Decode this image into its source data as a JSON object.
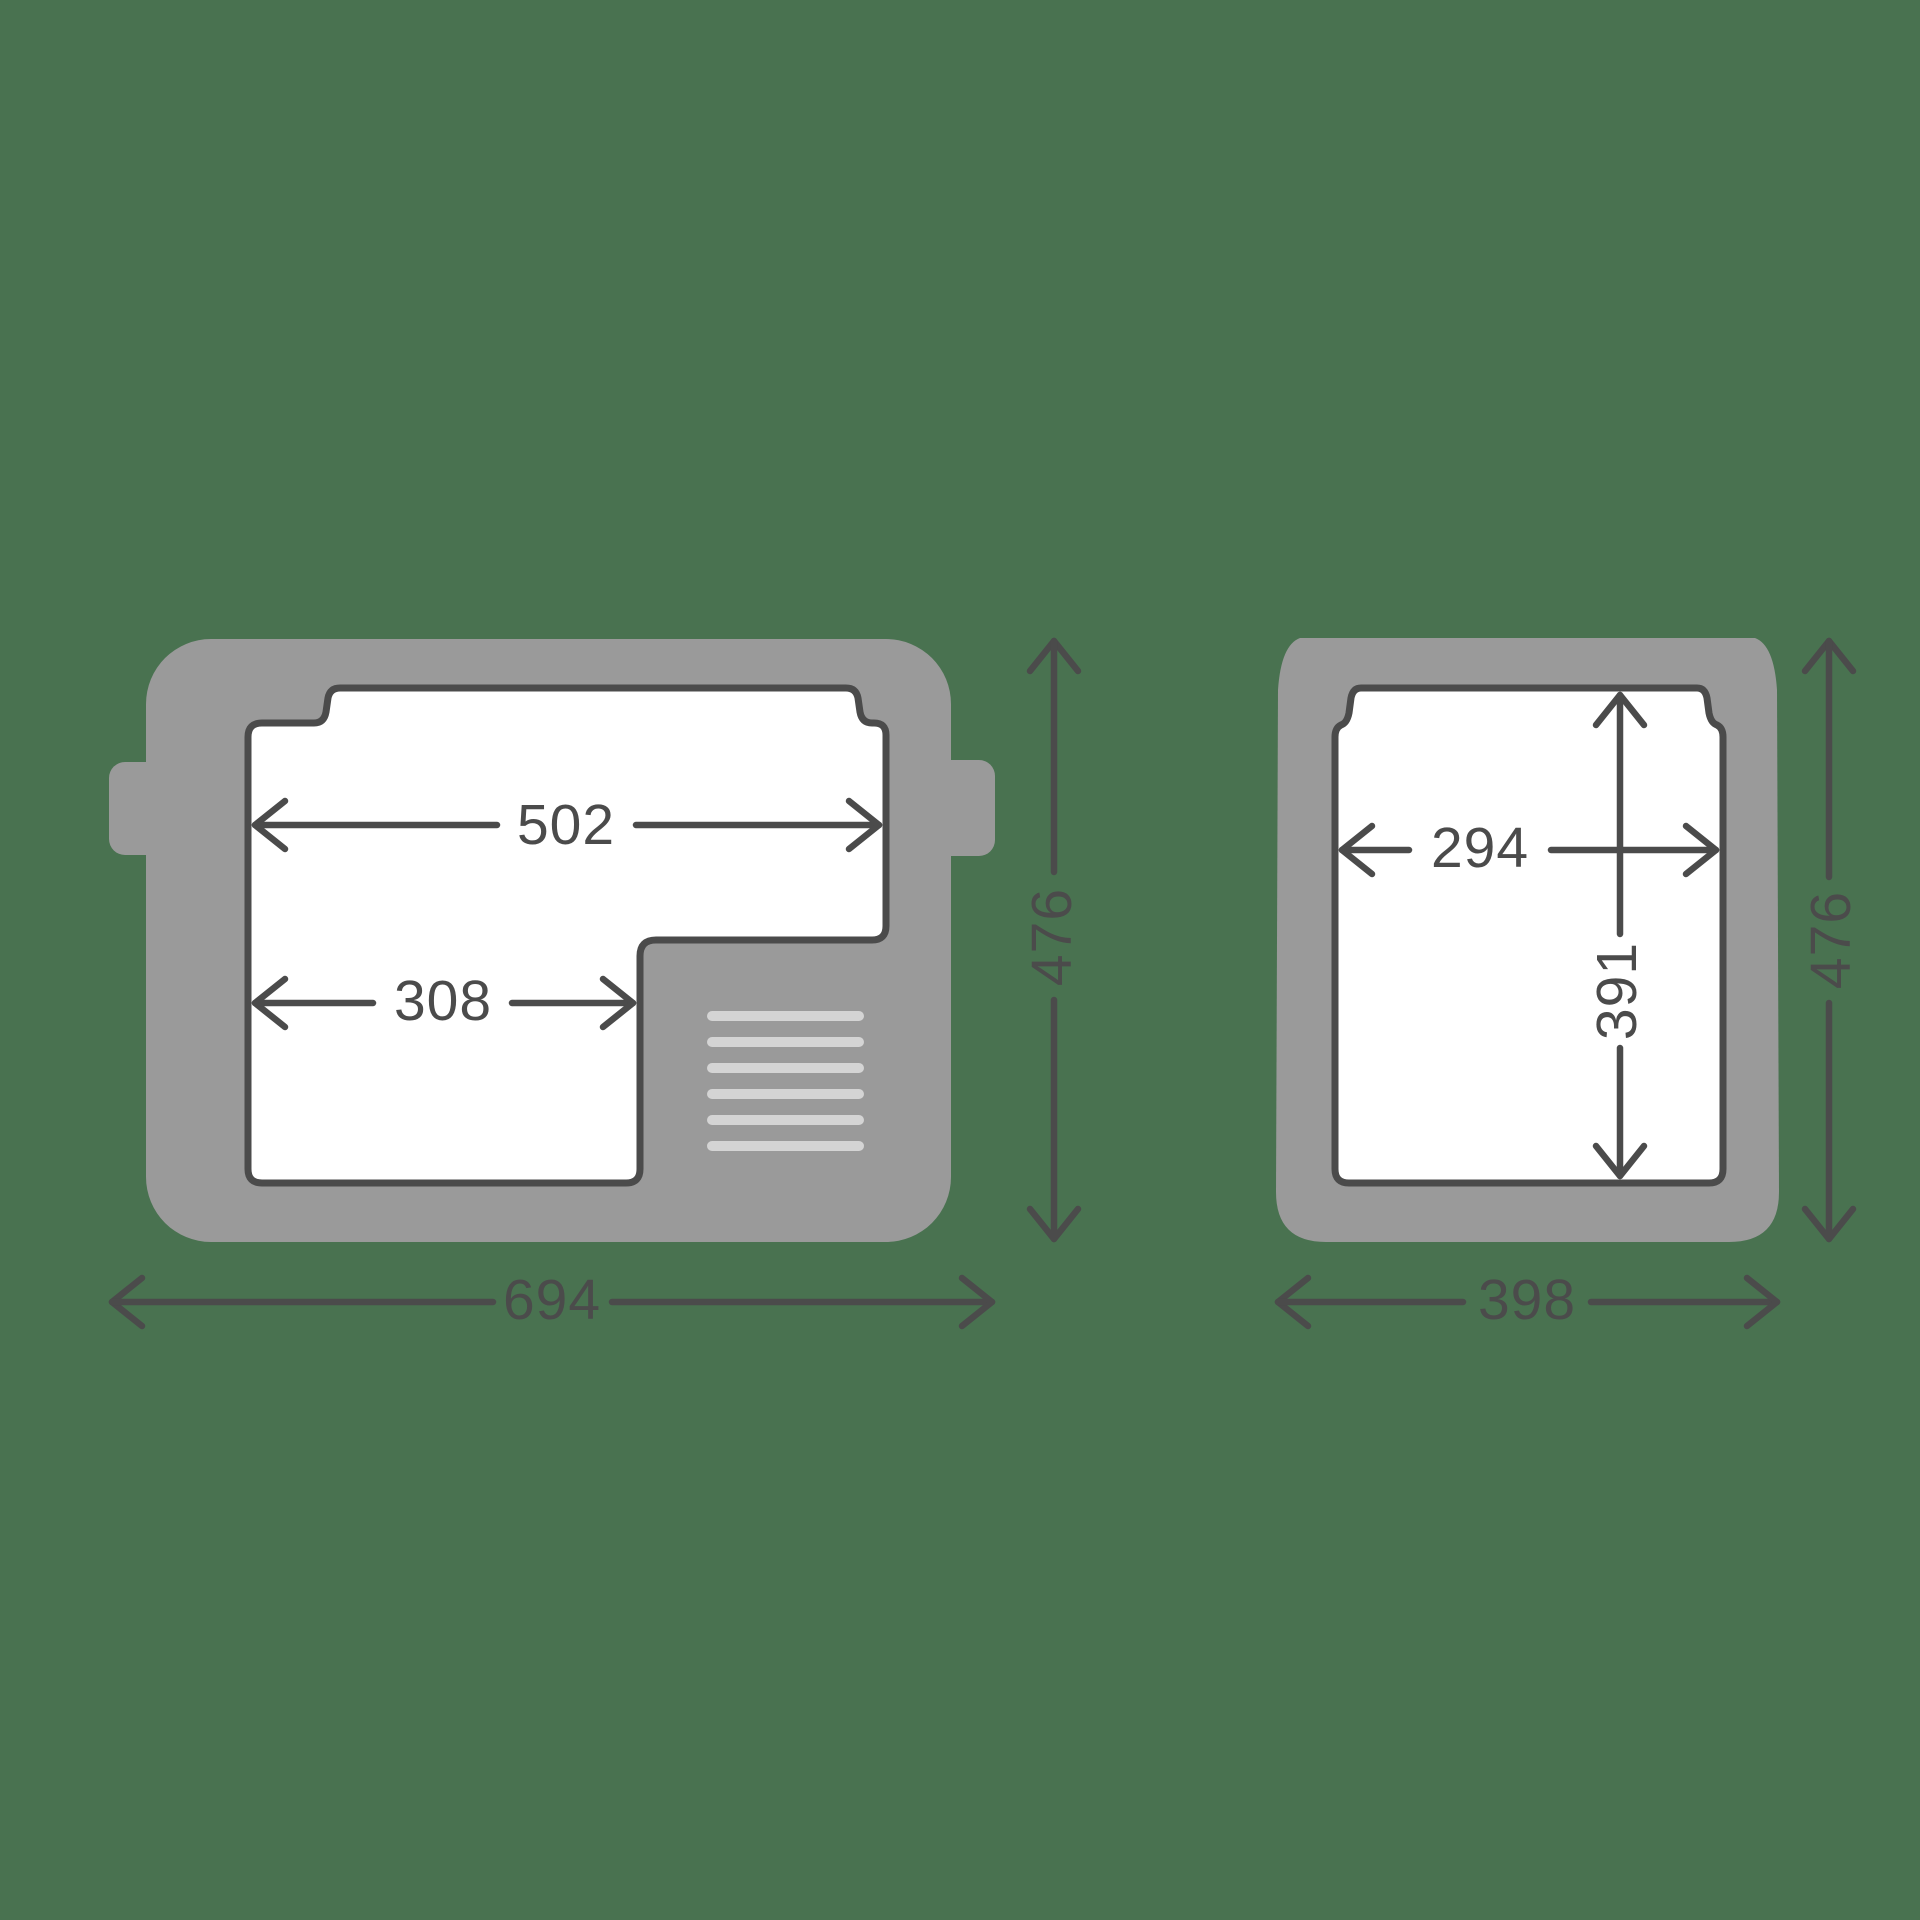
{
  "colors": {
    "background": "#497250",
    "body_gray": "#9A9A9A",
    "cutout_white": "#FFFFFF",
    "outline_dark": "#4B4B4B",
    "vent_light_gray": "#D4D4D4"
  },
  "top_view": {
    "inner_width_label": "502",
    "inner_partial_width_label": "308",
    "overall_height_label": "476",
    "overall_width_label": "694",
    "vent_line_count": 6
  },
  "front_view": {
    "inner_width_label": "294",
    "inner_height_label": "391",
    "overall_height_label": "476",
    "overall_width_label": "398"
  }
}
